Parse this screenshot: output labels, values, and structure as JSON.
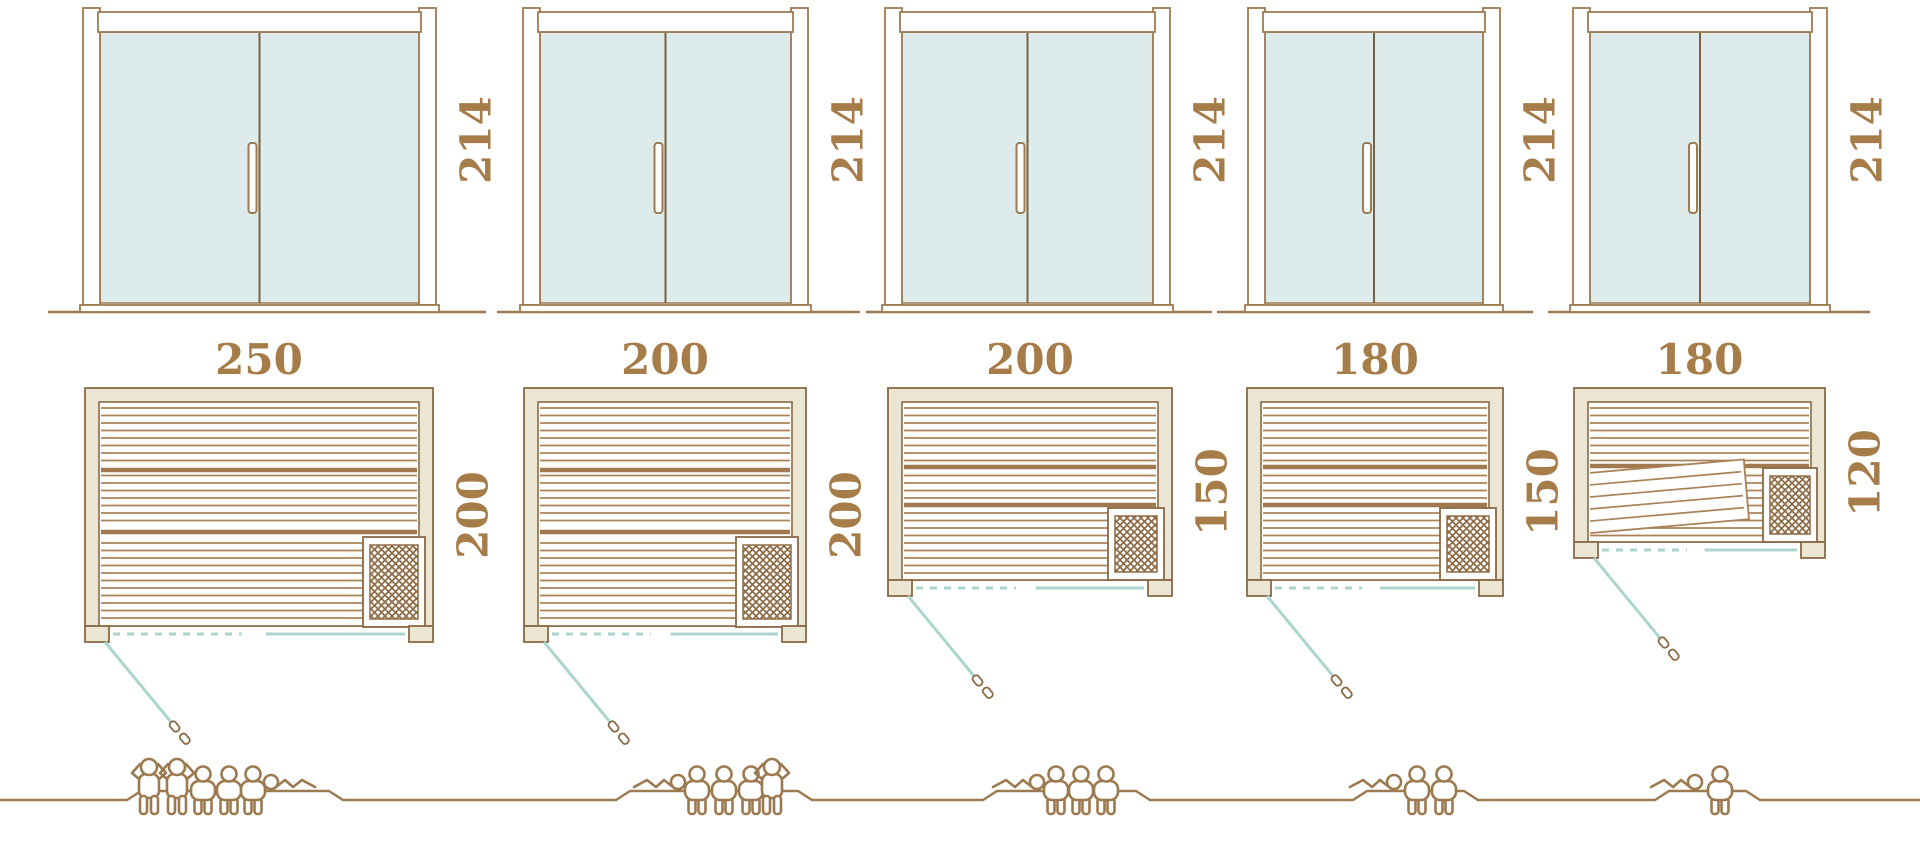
{
  "diagram": {
    "unit_note": "",
    "colors": {
      "outline_brown": "#9c7b50",
      "slat_brown": "#aa8257",
      "band_brown": "#a07a4e",
      "wall_beige": "#eae6d3",
      "glass_teal": "#ddecea",
      "swing_teal": "#abd5ce",
      "label_brown": "#a67c48",
      "figure_brown": "#9c7a4f",
      "divider_brown": "#7c5f41"
    },
    "columns": [
      {
        "door_height": "214",
        "width": "250",
        "depth": "200",
        "capacity": {
          "standing": 2,
          "seated": 3,
          "reclining": 1,
          "total": 6
        }
      },
      {
        "door_height": "214",
        "width": "200",
        "depth": "200",
        "capacity": {
          "standing": 1,
          "seated": 3,
          "reclining": 1,
          "total": 5
        }
      },
      {
        "door_height": "214",
        "width": "200",
        "depth": "150",
        "capacity": {
          "standing": 0,
          "seated": 3,
          "reclining": 1,
          "total": 4
        }
      },
      {
        "door_height": "214",
        "width": "180",
        "depth": "150",
        "capacity": {
          "standing": 0,
          "seated": 2,
          "reclining": 1,
          "total": 3
        }
      },
      {
        "door_height": "214",
        "width": "180",
        "depth": "120",
        "capacity": {
          "standing": 0,
          "seated": 1,
          "reclining": 1,
          "total": 2
        }
      }
    ]
  }
}
